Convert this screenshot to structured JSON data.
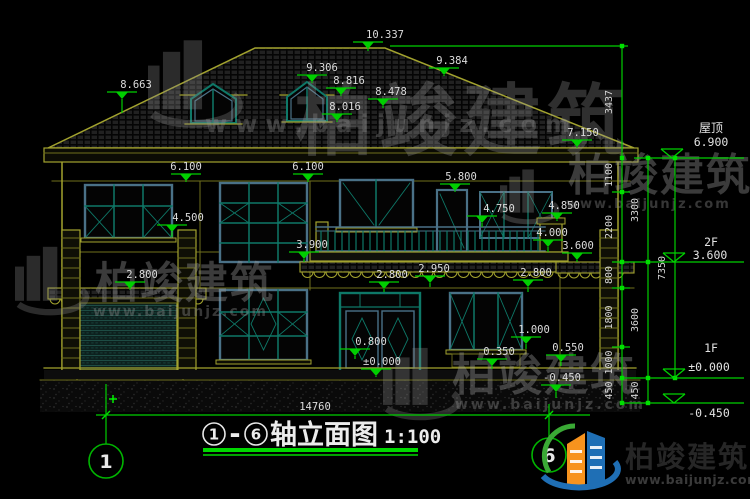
{
  "drawing": {
    "title_axis_start": "1",
    "title_dash": "-",
    "title_axis_end": "6",
    "title_text": "轴立面图",
    "title_scale": "1:100",
    "bottom_dim": "14760",
    "axis_bubble_left": "1",
    "axis_bubble_right": "6"
  },
  "marks": {
    "apex": "10.337",
    "dormer_ridge": "9.306",
    "dormer_eave": "8.816",
    "roof_valley": "8.478",
    "dormer_sill": "8.016",
    "right_hip": "9.384",
    "left_hip": "8.663",
    "main_eave": "7.150",
    "wall_top_left": "6.100",
    "wall_top_mid": "6.100",
    "balcony_door_top": "5.800",
    "window_2f_sill": "4.500",
    "railing_top": "4.750",
    "balcony_pier_top": "4.850",
    "balcony_slab": "4.000",
    "stair_window_sill_2f": "3.900",
    "wing_eave": "3.600",
    "band_bottom": "2.950",
    "garage_canopy": "2.800",
    "entry_canopy": "2.800",
    "window_1f_top": "2.800",
    "window_1f_sill": "1.000",
    "stair_window_sill_1f": "0.800",
    "right_plinth": "0.550",
    "window_apron": "0.350",
    "entry_platform": "±0.000",
    "ground_right": "-0.450"
  },
  "levels": {
    "roof": {
      "label": "屋顶",
      "value": "6.900"
    },
    "f2": {
      "label": "2F",
      "value": "3.600"
    },
    "f1": {
      "label": "1F",
      "value": "±0.000"
    },
    "ground": {
      "label": "",
      "value": "-0.450"
    }
  },
  "chains": {
    "col1": [
      "3437",
      "1100",
      "2200",
      "800",
      "1800",
      "1000",
      "450"
    ],
    "col2": [
      "3300",
      "3600",
      "450"
    ],
    "col3": [
      "7350"
    ]
  },
  "watermark": {
    "brand": "柏竣建筑",
    "url": "www.baijunjz.com"
  },
  "logo": {
    "brand": "柏竣建筑",
    "url": "www.baijunjz.com"
  },
  "colors": {
    "dim_green": "#00cf00",
    "line_olive": "#a2a22e",
    "text_white": "#dcdcdc",
    "frame_blue": "#4a7187",
    "mullion_teal": "#0e7868",
    "logo_orange": "#f7931e",
    "logo_blue": "#1f6fb5",
    "logo_green": "#3aa935"
  }
}
